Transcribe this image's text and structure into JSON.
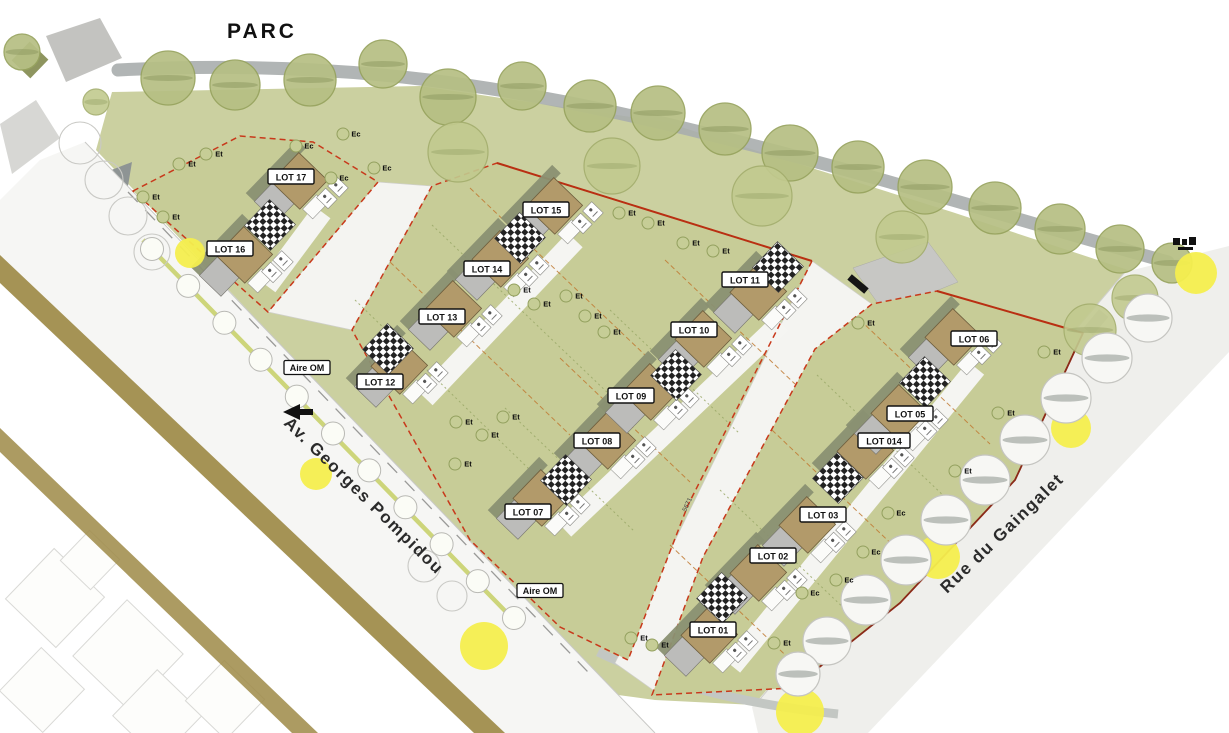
{
  "park": {
    "label": "PARC"
  },
  "streets": {
    "avenue": {
      "label": "Av. Georges Pompidou"
    },
    "rue": {
      "label": "Rue du Gaingalet"
    }
  },
  "lots": [
    {
      "label": "LOT 01",
      "x": 713,
      "y": 630
    },
    {
      "label": "LOT 02",
      "x": 773,
      "y": 556
    },
    {
      "label": "LOT 03",
      "x": 823,
      "y": 515
    },
    {
      "label": "LOT 014",
      "x": 884,
      "y": 441
    },
    {
      "label": "LOT 05",
      "x": 910,
      "y": 414
    },
    {
      "label": "LOT 06",
      "x": 974,
      "y": 339
    },
    {
      "label": "LOT 07",
      "x": 528,
      "y": 512
    },
    {
      "label": "LOT 08",
      "x": 597,
      "y": 441
    },
    {
      "label": "LOT 09",
      "x": 631,
      "y": 396
    },
    {
      "label": "LOT 10",
      "x": 694,
      "y": 330
    },
    {
      "label": "LOT 11",
      "x": 745,
      "y": 280
    },
    {
      "label": "LOT 12",
      "x": 380,
      "y": 382
    },
    {
      "label": "LOT 13",
      "x": 442,
      "y": 317
    },
    {
      "label": "LOT 14",
      "x": 487,
      "y": 269
    },
    {
      "label": "LOT 15",
      "x": 546,
      "y": 210
    },
    {
      "label": "LOT 16",
      "x": 230,
      "y": 249
    },
    {
      "label": "LOT 17",
      "x": 291,
      "y": 177
    }
  ],
  "annotations": {
    "aire_om": [
      {
        "label": "Aire OM",
        "x": 307,
        "y": 368
      },
      {
        "label": "Aire OM",
        "x": 540,
        "y": 591
      }
    ],
    "dimension": {
      "label": "5671",
      "x": 686,
      "y": 512
    }
  },
  "tree_tags": [
    {
      "t": "Et",
      "x": 188,
      "y": 163
    },
    {
      "t": "Et",
      "x": 215,
      "y": 153
    },
    {
      "t": "Et",
      "x": 152,
      "y": 196
    },
    {
      "t": "Et",
      "x": 172,
      "y": 216
    },
    {
      "t": "Ec",
      "x": 305,
      "y": 145
    },
    {
      "t": "Ec",
      "x": 352,
      "y": 133
    },
    {
      "t": "Ec",
      "x": 340,
      "y": 177
    },
    {
      "t": "Ec",
      "x": 383,
      "y": 167
    },
    {
      "t": "Et",
      "x": 628,
      "y": 212
    },
    {
      "t": "Et",
      "x": 657,
      "y": 222
    },
    {
      "t": "Et",
      "x": 692,
      "y": 242
    },
    {
      "t": "Et",
      "x": 722,
      "y": 250
    },
    {
      "t": "Et",
      "x": 575,
      "y": 295
    },
    {
      "t": "Et",
      "x": 594,
      "y": 315
    },
    {
      "t": "Et",
      "x": 523,
      "y": 289
    },
    {
      "t": "Et",
      "x": 543,
      "y": 303
    },
    {
      "t": "Et",
      "x": 613,
      "y": 331
    },
    {
      "t": "Et",
      "x": 465,
      "y": 421
    },
    {
      "t": "Et",
      "x": 512,
      "y": 416
    },
    {
      "t": "Et",
      "x": 491,
      "y": 434
    },
    {
      "t": "Et",
      "x": 464,
      "y": 463
    },
    {
      "t": "Et",
      "x": 640,
      "y": 637
    },
    {
      "t": "Et",
      "x": 661,
      "y": 644
    },
    {
      "t": "Et",
      "x": 783,
      "y": 642
    },
    {
      "t": "Et",
      "x": 1053,
      "y": 351
    },
    {
      "t": "Et",
      "x": 1007,
      "y": 412
    },
    {
      "t": "Et",
      "x": 964,
      "y": 470
    },
    {
      "t": "Et",
      "x": 867,
      "y": 322
    },
    {
      "t": "Ec",
      "x": 897,
      "y": 512
    },
    {
      "t": "Ec",
      "x": 872,
      "y": 551
    },
    {
      "t": "Ec",
      "x": 845,
      "y": 579
    },
    {
      "t": "Ec",
      "x": 811,
      "y": 592
    }
  ],
  "colors": {
    "park_green": "#cbd0a0",
    "parcel_green": "#c7cc97",
    "tree_olive": "#b6bf84",
    "building_tan": "#b29a6a",
    "roof_gray": "#bcbcba",
    "shadow_olive": "#8a9072",
    "boundary_red": "#c8391b",
    "accent_yellow": "#f4ee4e",
    "khaki_band": "#9d8a46",
    "path_gray": "#a8adad",
    "street_white": "#f6f6f4"
  }
}
